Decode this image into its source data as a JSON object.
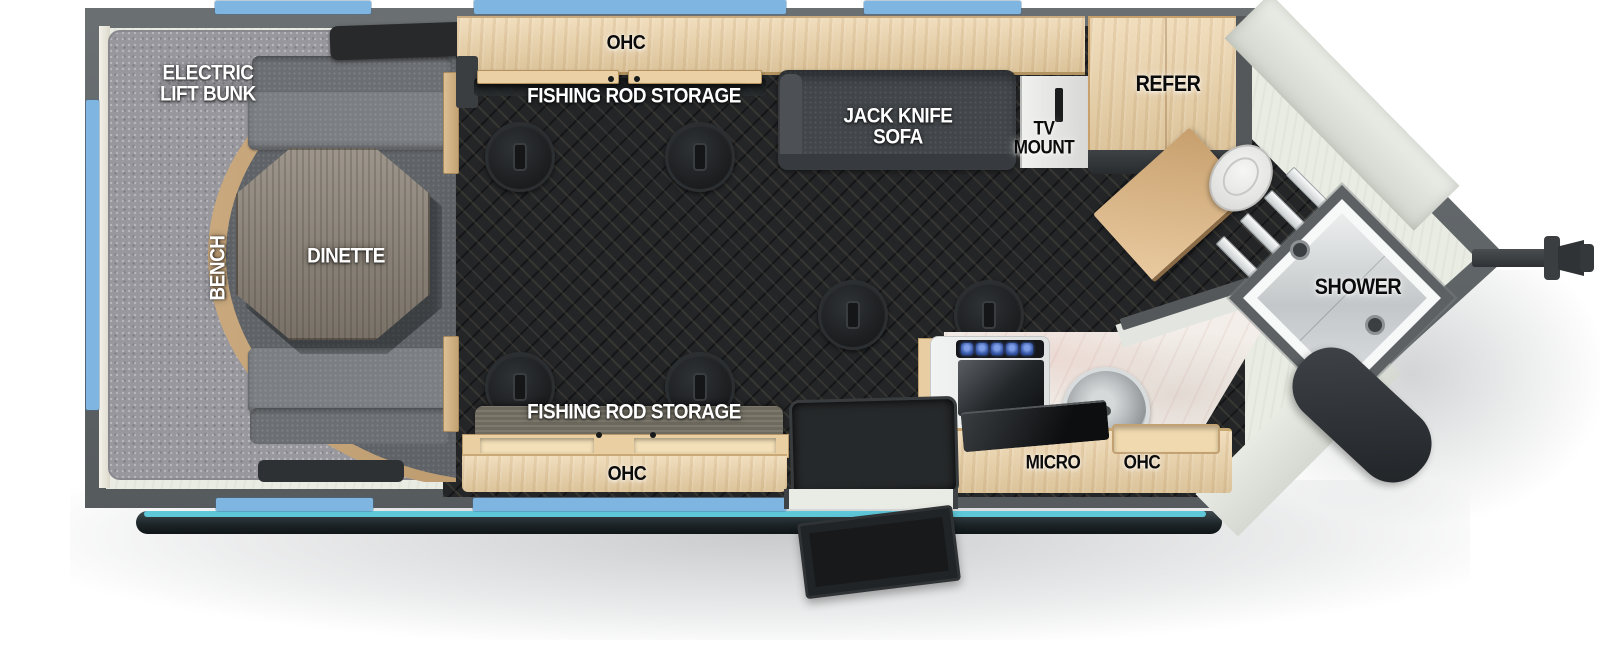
{
  "diagram": {
    "type": "rv-floorplan",
    "description": "Top-down travel trailer / fish house floor plan with V-nose front on the right, hitch coupler, awning tube and entry door along the bottom wall",
    "floor_anchor_count": 6,
    "window_count": 6
  },
  "labels": {
    "bunk": "ELECTRIC\nLIFT BUNK",
    "bench": "BENCH",
    "dinette": "DINETTE",
    "ohc_top": "OHC",
    "rod_storage_top": "FISHING ROD STORAGE",
    "sofa": "JACK KNIFE\nSOFA",
    "tv_mount": "TV\nMOUNT",
    "refer": "REFER",
    "shower": "SHOWER",
    "rod_storage_bottom": "FISHING ROD STORAGE",
    "ohc_bottom": "OHC",
    "micro": "MICRO",
    "ohc_kitchen": "OHC"
  },
  "colors": {
    "wall_gray": "#5b6063",
    "window_blue": "#7fb6e1",
    "awning_teal": "#5ec7d8",
    "awning_tube": "#1e2629",
    "floor_dark": "#232527",
    "floor_light": "#e9ece3",
    "wood_light": "#ecd2a6",
    "wood_trim": "#c9a87d",
    "bunk_gray": "#97979d",
    "bench_gray": "#7b7e82",
    "sofa_charcoal": "#42464a",
    "table_wood": "#8d8478",
    "marble": "#f3eee9",
    "burner_blue": "#2e4f9e"
  }
}
